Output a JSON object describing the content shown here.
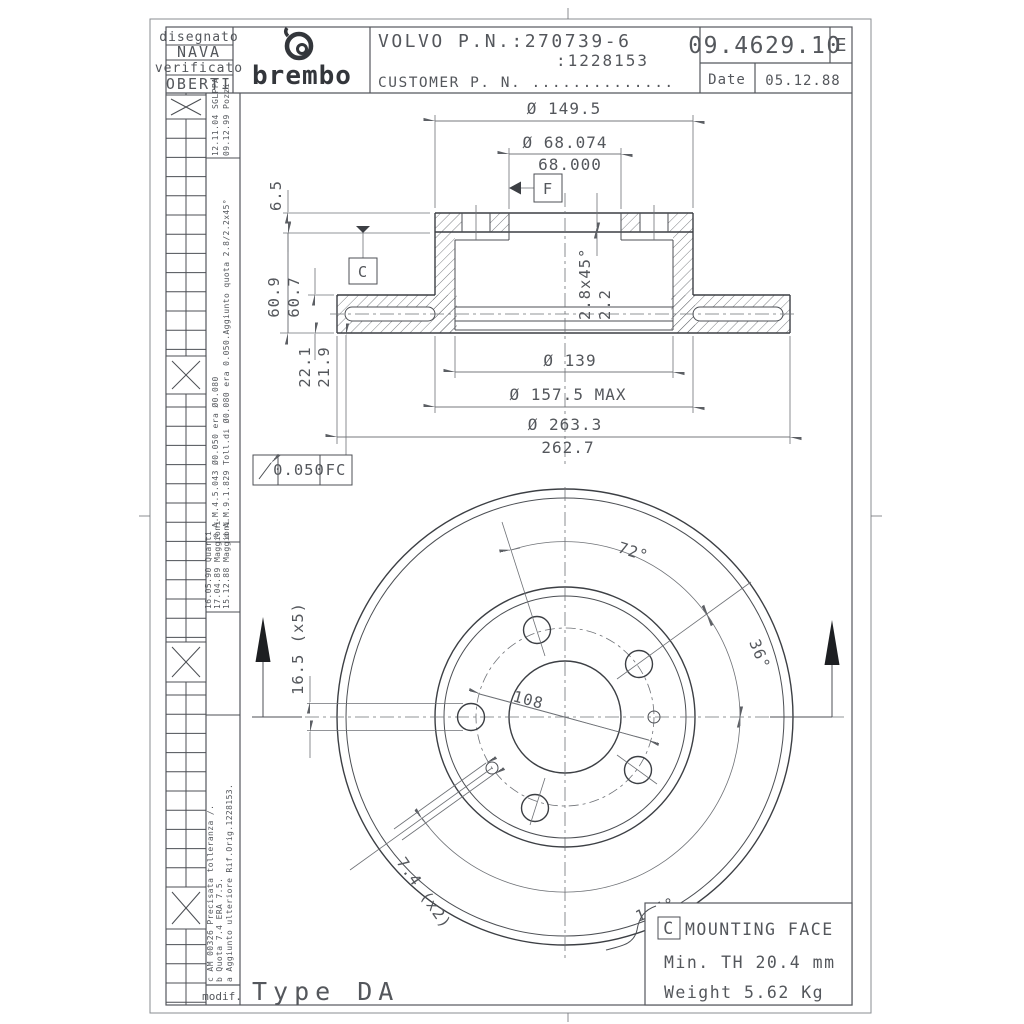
{
  "title_block": {
    "designed_label": "disegnato",
    "designed_name": "NAVA",
    "verified_label": "verificato",
    "verified_name": "OBERTI",
    "brand": "brembo",
    "part_line1": "VOLVO P.N.:270739-6",
    "part_line2": ":1228153",
    "part_line3": "CUSTOMER P. N. ..............",
    "drawing_number": "09.4629.10",
    "revision": "E",
    "date_label": "Date",
    "date_value": "05.12.88"
  },
  "revision_table": {
    "e1": "12.11.04 SGLPPA",
    "e2": "09.12.99 Pozzi",
    "e3": "e  A.M.4.5.043  Ø0.050 era Ø0.080",
    "e4": "d  A.M.9.1.829  Toll.di Ø0.080 era 0.050.Aggiunto quota 2.8/2.2x45°",
    "e5": "16.05.90 Quarti",
    "e6": "17.04.89 Maggioni",
    "e7": "15.12.88 Maggioni",
    "e8": "c AM 00326 Precisata tolleranza ∕.",
    "e9": "b Quota 7.4 ERA 7.5.",
    "e10": "a Aggiunto ulteriore Rif.Orig.1228153.",
    "modif_label": "modif."
  },
  "section": {
    "dia_149_5": "Ø 149.5",
    "dia_68_074": "Ø 68.074",
    "dia_68_000": "68.000",
    "dim_6_5": "6.5",
    "dim_60_9": "60.9",
    "dim_60_7": "60.7",
    "dim_22_1": "22.1",
    "dim_21_9": "21.9",
    "chamfer": "2.8x45°",
    "chamfer_leg": "2.2",
    "dia_139": "Ø 139",
    "dia_157_5": "Ø 157.5 MAX",
    "dia_263_3": "Ø 263.3",
    "dia_262_7": "262.7",
    "runout_value": "0.050",
    "runout_datum": "FC",
    "datum_c": "C",
    "datum_f": "F"
  },
  "front": {
    "angle_72": "72°",
    "angle_36": "36°",
    "angle_144": "144°",
    "bolt_circle": "108",
    "hole_dia": "16.5 (x5)",
    "pin_hole_dia": "7.4 (x2)"
  },
  "notes": {
    "type_label": "Type DA",
    "mount_datum": "C",
    "mount_label": "MOUNTING FACE",
    "min_thickness": "Min. TH 20.4 mm",
    "weight": "Weight  5.62 Kg"
  }
}
